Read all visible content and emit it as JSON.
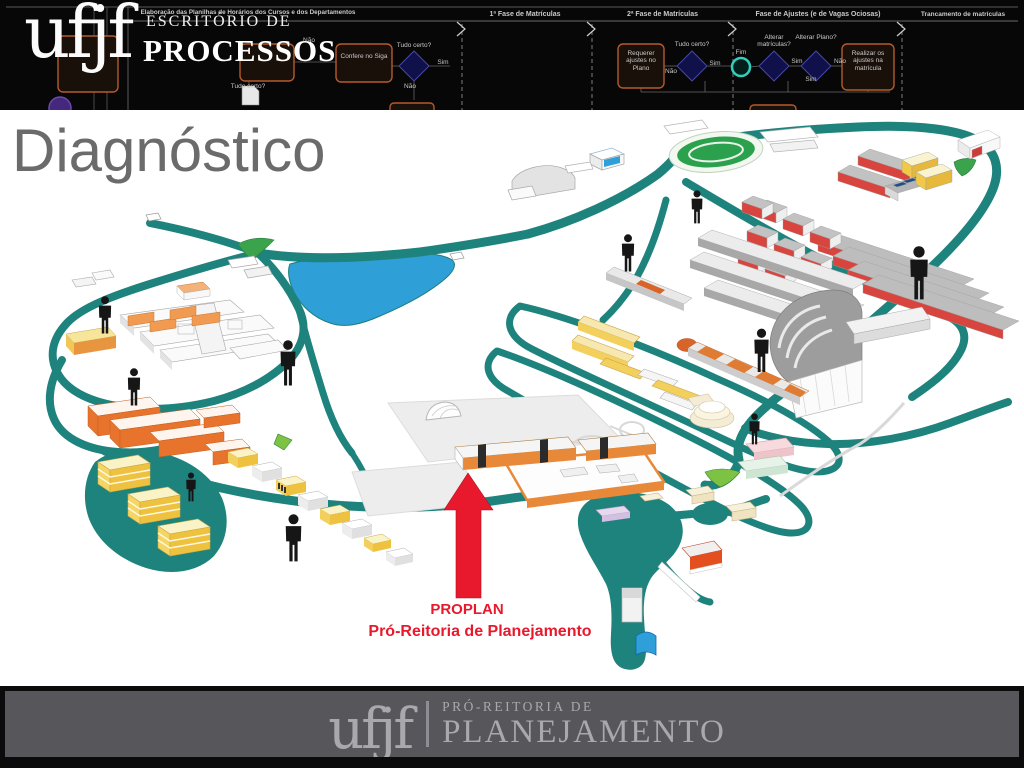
{
  "header": {
    "logo_text": "ufjf",
    "office_name_line1": "ESCRITÓRIO DE",
    "office_name_line2": "PROCESSOS",
    "process_title": "Elaboração das Planilhas de Horários dos Cursos e dos Departamentos",
    "lanes": [
      "1ª Fase de Matrículas",
      "2ª Fase de Matrículas",
      "Fase de Ajustes (e de Vagas Ociosas)",
      "Trancamento de matrículas"
    ],
    "flowchart": {
      "confere_siga": "Confere no Siga",
      "requerer_ajustes": "Requerer ajustes no Plano",
      "realizar_ajustes": "Realizar os ajustes na matrícula",
      "alterar_matriculas": "Alterar matrículas?",
      "alterar_plano": "Alterar Plano?",
      "tudo_certo": "Tudo certo?",
      "sim": "Sim",
      "nao": "Não",
      "fim": "Fim"
    }
  },
  "slide": {
    "title": "Diagnóstico"
  },
  "map": {
    "callout_title": "PROPLAN",
    "callout_subtitle": "Pró-Reitoria de Planejamento",
    "colors": {
      "road": "#1f837d",
      "lake": "#2f9fd8",
      "sports_field": "#2ba14e",
      "callout_red": "#e8192c",
      "building_orange": "#e8893a",
      "building_yellow": "#f3cf5c",
      "building_red": "#d8453e"
    }
  },
  "footer": {
    "logo_text": "ufjf",
    "org_line1": "PRÓ-REITORIA DE",
    "org_line2": "PLANEJAMENTO"
  }
}
